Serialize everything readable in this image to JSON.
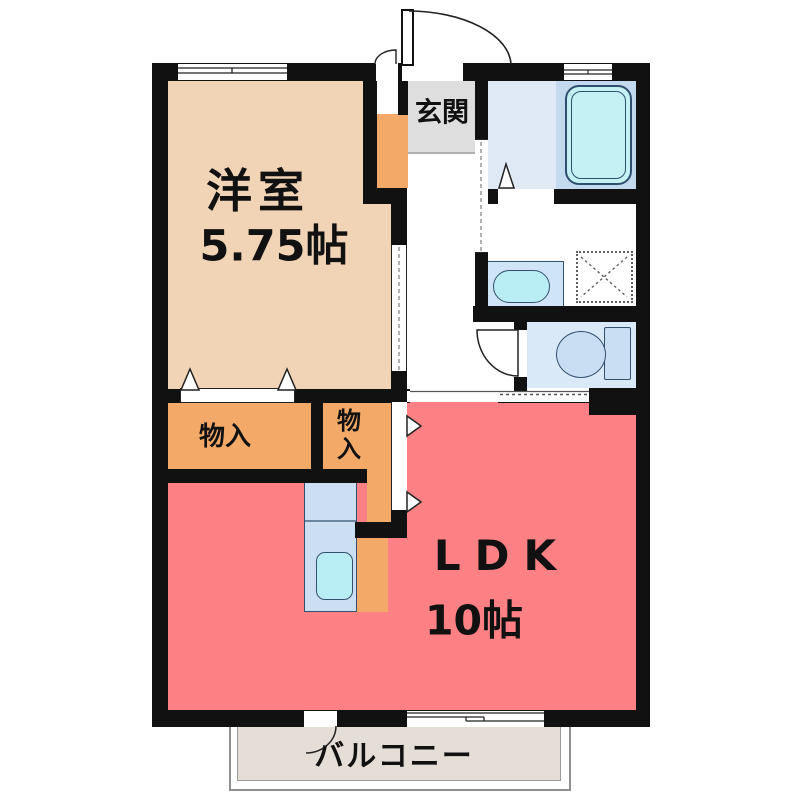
{
  "plan": {
    "type": "floor-plan",
    "style": "1LDK apartment"
  },
  "labels": {
    "western_room_name": "洋室",
    "western_room_size": "5.75帖",
    "entrance": "玄関",
    "ldk_name": "LDK",
    "ldk_size": "10帖",
    "storage_left": "物入",
    "storage_right_char1": "物",
    "storage_right_char2": "入",
    "balcony": "バルコニー"
  },
  "fixtures": [
    "bathtub-icon",
    "wash-basin-icon",
    "washing-machine-pan-icon",
    "toilet-icon",
    "kitchen-sink-icon",
    "shoe-cabinet-icon",
    "entrance-door-icon",
    "toilet-door-icon",
    "balcony-door-icon",
    "folding-door-icons",
    "sliding-door-icons",
    "window-icons"
  ],
  "colors": {
    "wall": "#111111",
    "western_room": "#f1d3b5",
    "storage": "#f3aa69",
    "ldk": "#fd8184",
    "entrance_floor": "#dedede",
    "bath_floor": "#dfeaf6",
    "tub_deck": "#c3d9ee",
    "bathtub": "#c3f1f4",
    "fixture_counter": "#cfe4f6",
    "basin": "#b9edf4",
    "toilet_room": "#d9e9f8",
    "kitchen_counter": "#ccdff2",
    "balcony_deck": "#e5ded6"
  }
}
